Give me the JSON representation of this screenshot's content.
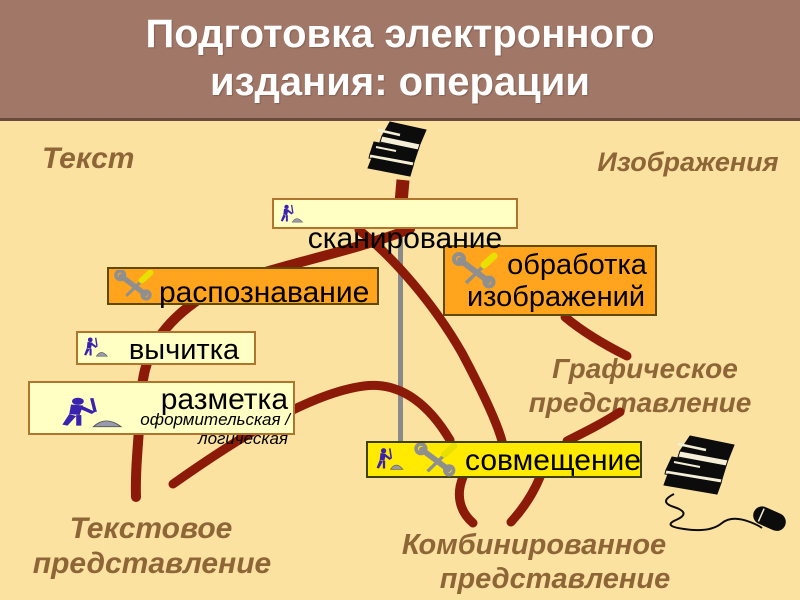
{
  "slide": {
    "title_line1": "Подготовка электронного",
    "title_line2": "издания: операции"
  },
  "labels": {
    "text": "Текст",
    "images": "Изображения",
    "graphic_line1": "Графическое",
    "graphic_line2": "представление",
    "textual_line1": "Текстовое",
    "textual_line2": "представление",
    "combined_line1": "Комбинированное",
    "combined_line2": "представление"
  },
  "nodes": {
    "scanning": "сканирование",
    "recognition": "распознавание",
    "image_processing_line1": "обработка",
    "image_processing_line2": "изображений",
    "proofreading": "вычитка",
    "markup": "разметка",
    "markup_sub1": "оформительская /",
    "markup_sub2": "логическая",
    "merge": "совмещение"
  },
  "icons": {
    "worker": "worker-digging-icon",
    "tools": "crossed-tools-icon",
    "books": "books-stack-icon",
    "books_mouse": "books-with-mouse-icon"
  },
  "colors": {
    "background": "#FBE2A1",
    "header_bg": "#A17868",
    "header_border": "#6B4A3E",
    "title_text": "#FFFFFF",
    "label_text": "#8E6537",
    "flow_curve": "#8B1A08",
    "connector_gray": "#8A8A8A",
    "box_pale_bg": "#FFFFC4",
    "box_pale_border": "#B0742C",
    "box_orange_bg": "#FFA41C",
    "box_yellow_bg": "#FFEA00",
    "node_text": "#000000"
  }
}
